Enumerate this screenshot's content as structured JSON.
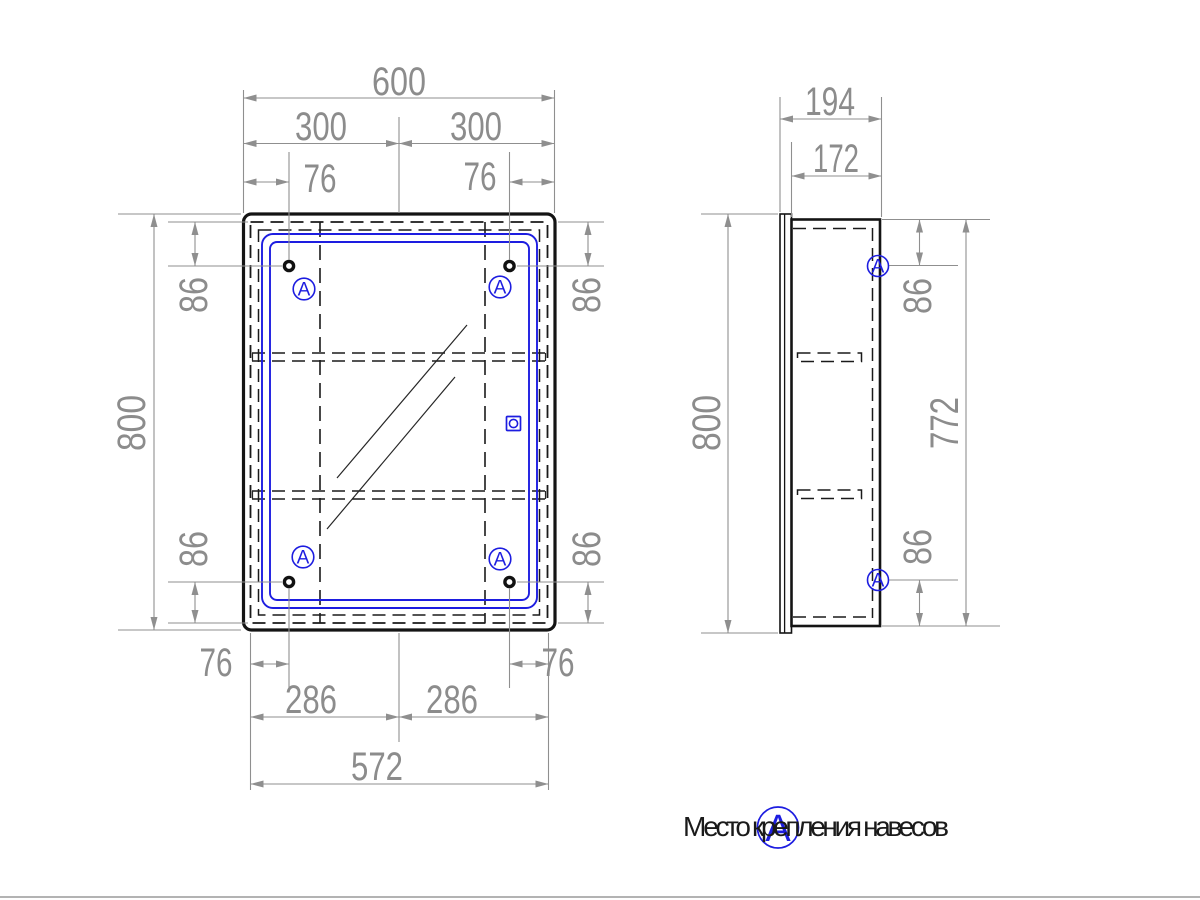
{
  "drawing": {
    "type": "furniture technical drawing - mirror cabinet, front and side views",
    "dims": {
      "front_top_total": "600",
      "front_top_left_half": "300",
      "front_top_right_half": "300",
      "front_top_left_offset": "76",
      "front_top_right_offset": "76",
      "front_left_height": "800",
      "front_left_top_offset": "86",
      "front_left_bottom_offset": "86",
      "front_right_top_offset": "86",
      "front_right_bottom_offset": "86",
      "front_bottom_left_offset": "76",
      "front_bottom_right_offset": "76",
      "front_bottom_left_half": "286",
      "front_bottom_right_half": "286",
      "front_bottom_total": "572",
      "side_top_total": "194",
      "side_top_inner": "172",
      "side_left_height": "800",
      "side_right_inner_height": "772",
      "side_right_top_offset": "86",
      "side_right_bottom_offset": "86"
    },
    "markers": {
      "letter": "A"
    },
    "legend": {
      "letter": "A",
      "text": "Место крепления навесов"
    },
    "colors": {
      "object_line": "#141414",
      "dimension_line": "#8f8f8f",
      "accent_blue": "#1d1de0",
      "footer_rule": "#b3b3b3"
    }
  }
}
